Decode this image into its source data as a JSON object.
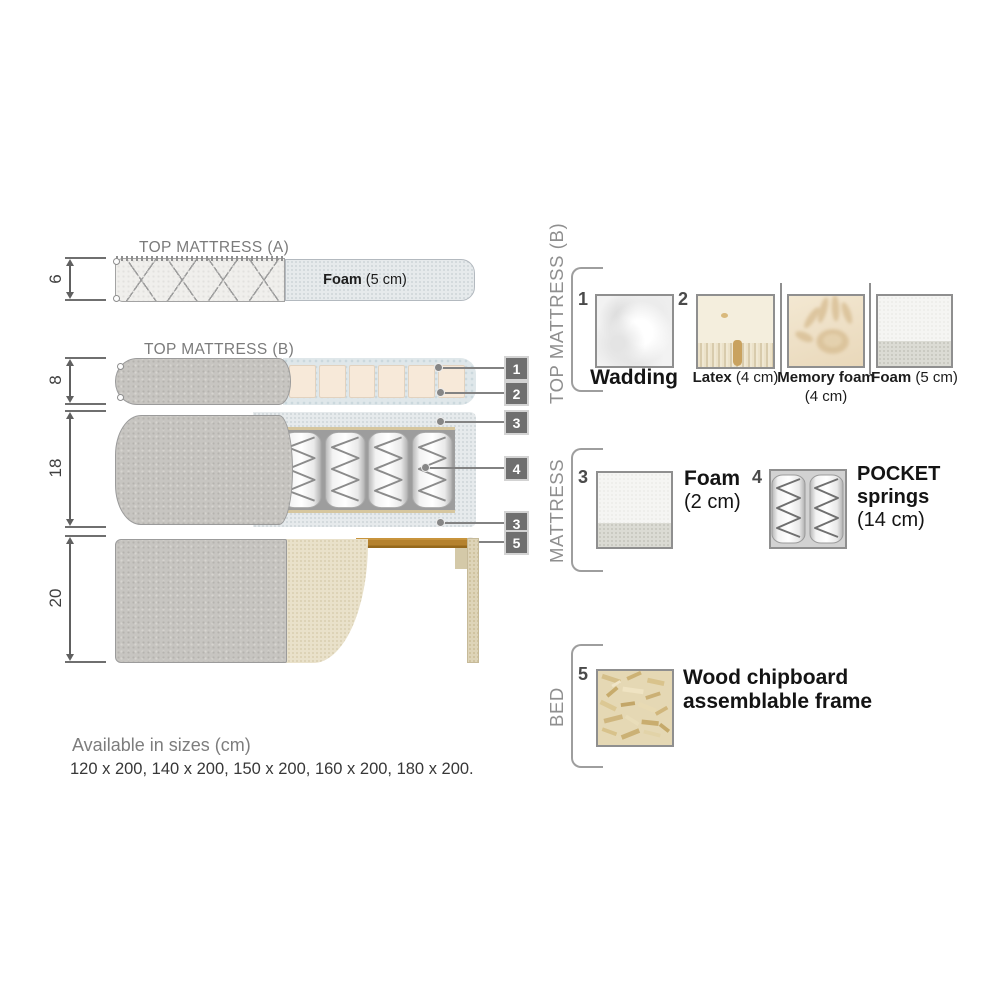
{
  "palette": {
    "fabric_gray": "#c7c5c1",
    "foam_blue_gray": "#e6eaec",
    "latex_cream": "#f7e9d9",
    "bed_beige": "#e9e1ca",
    "wood_brown": "#b5822e",
    "chipboard_tan": "#ded4b8",
    "callout_box_gray": "#6f6f6f",
    "title_text_gray": "#7b7b7b"
  },
  "diagram": {
    "top_a": {
      "title": "TOP MATTRESS (A)",
      "dim": "6",
      "foam_name": "Foam",
      "foam_detail": " (5 cm)"
    },
    "top_b": {
      "title": "TOP MATTRESS (B)",
      "dim": "8"
    },
    "mattress": {
      "dim": "18"
    },
    "bed": {
      "dim": "20"
    },
    "callouts": [
      {
        "num": "1"
      },
      {
        "num": "2"
      },
      {
        "num": "3"
      },
      {
        "num": "4"
      },
      {
        "num": "3"
      },
      {
        "num": "5"
      }
    ]
  },
  "legend": {
    "top_b": {
      "section_title": "TOP MATTRESS (B)",
      "item1_num": "1",
      "item1_name": "Wadding",
      "item2_num": "2",
      "item2_name": "Latex",
      "item2_detail": " (4 cm)",
      "item3_name": "Memory foam",
      "item3_detail": " (4 cm)",
      "item4_name": "Foam",
      "item4_detail": " (5 cm)"
    },
    "mattress": {
      "section_title": "MATTRESS",
      "item1_num": "3",
      "item1_name": "Foam",
      "item1_detail": "(2 cm)",
      "item2_num": "4",
      "item2_name": "POCKET springs",
      "item2_detail": "(14 cm)"
    },
    "bed": {
      "section_title": "BED",
      "item1_num": "5",
      "item1_name": "Wood chipboard assemblable frame"
    }
  },
  "sizes": {
    "heading": "Available in sizes (cm)",
    "values": "120 x 200, 140 x 200, 150 x 200, 160 x 200, 180 x 200."
  }
}
